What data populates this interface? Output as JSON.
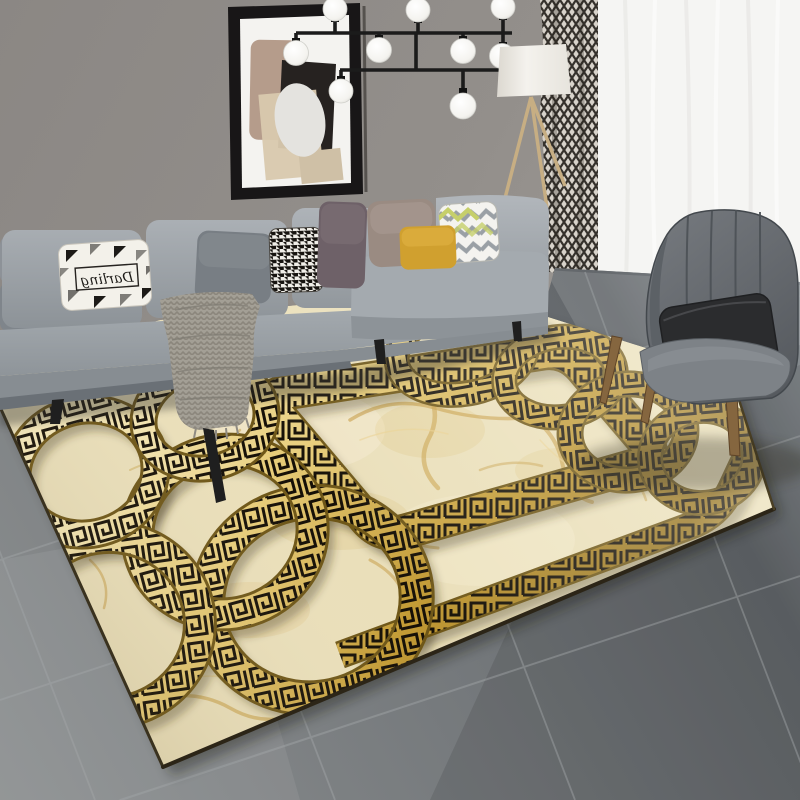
{
  "scene": {
    "kind": "living-room-product-photo",
    "subject": "gold greek-key chain rug in modern living room",
    "pillow_text": "Darling"
  },
  "colors": {
    "wall": "#8f8b87",
    "floor": "#74787b",
    "floor_light": "#9aa0a4",
    "rug_base": "#eadfba",
    "rug_gold": "#c79d35",
    "rug_pattern_black": "#150f06",
    "sofa": "#989ea4",
    "curtain_sheer": "#f5f5f3",
    "curtain_pattern": "#45403b",
    "armchair": "#686d72",
    "armchair_pillow": "#2b2c2e",
    "pillow_mustard": "#d0a02f",
    "pillow_mauve": "#6e6168",
    "pillow_taupe": "#9a8b82",
    "throw": "#a39f95",
    "lamp_shade": "#f1efe9",
    "lamp_legs": "#c7ae83",
    "chair_leg_wood": "#85663f",
    "art_frame": "#181617",
    "chandelier_metal": "#1b1b1b",
    "bulb": "#fbfbf9"
  }
}
